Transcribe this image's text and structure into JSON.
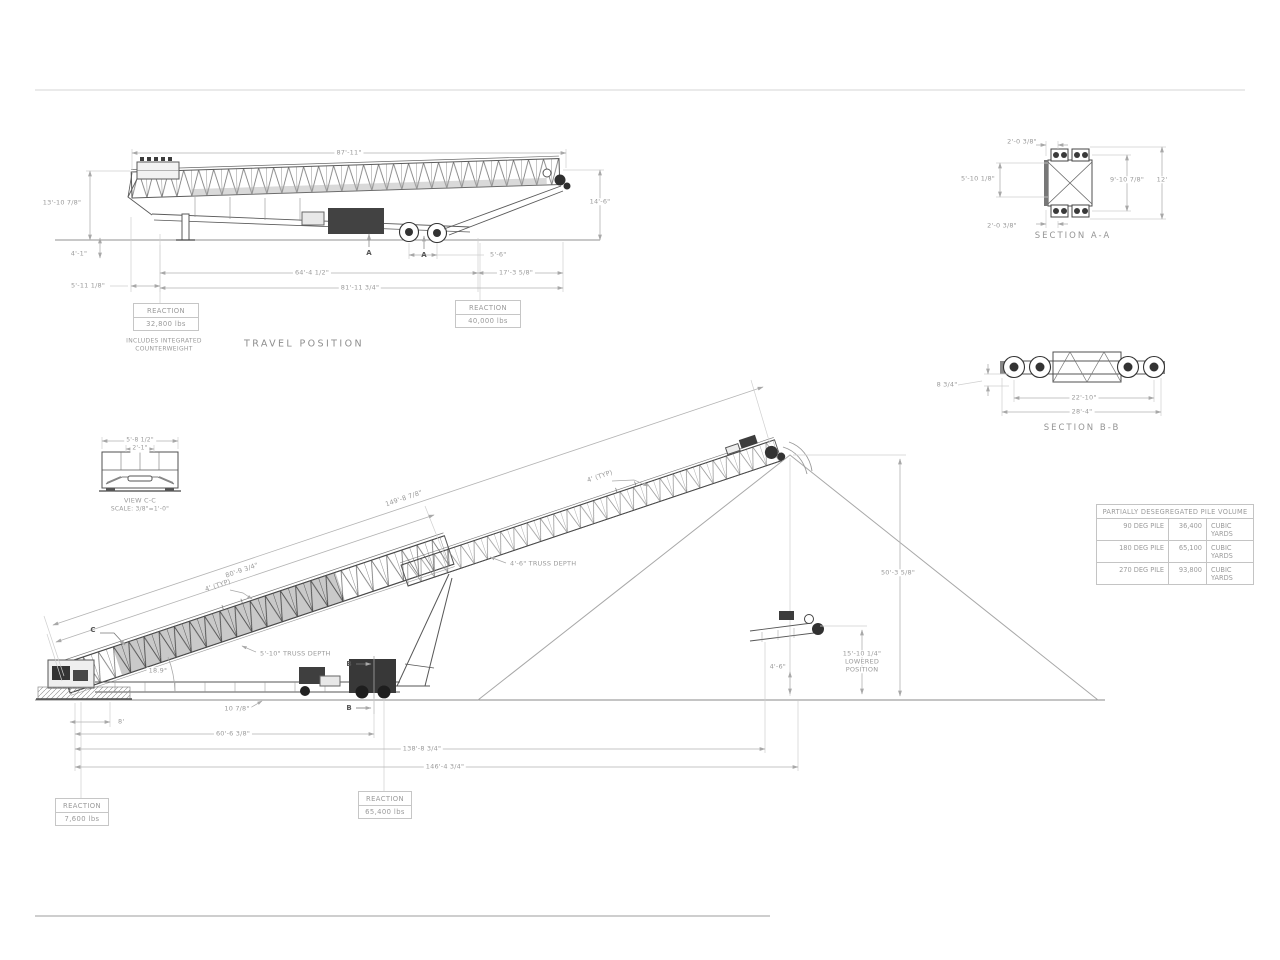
{
  "travel": {
    "title": "TRAVEL POSITION",
    "marker": "A",
    "dims": {
      "overall_top": "87'-11\"",
      "left_height": "13'-10 7/8\"",
      "right_height": "14'-6\"",
      "tail_height": "4'-1\"",
      "tail_overhang": "5'-11 1/8\"",
      "axle_span": "64'-4 1/2\"",
      "head_overhang": "17'-3 5/8\"",
      "overall_bottom": "81'-11 3/4\"",
      "axle_spacing": "5'-6\""
    },
    "reaction_left": {
      "label": "REACTION",
      "value": "32,800 lbs"
    },
    "reaction_left_note": {
      "line1": "INCLUDES INTEGRATED",
      "line2": "COUNTERWEIGHT"
    },
    "reaction_right": {
      "label": "REACTION",
      "value": "40,000 lbs"
    }
  },
  "section_aa": {
    "title": "SECTION A-A",
    "dims": {
      "top_offset": "2'-0 3/8\"",
      "left_width": "5'-10 1/8\"",
      "inner_height": "9'-10 7/8\"",
      "outer_height": "12'",
      "bottom_offset": "2'-0 3/8\""
    }
  },
  "section_bb": {
    "title": "SECTION B-B",
    "dims": {
      "drop": "8 3/4\"",
      "inner_span": "22'-10\"",
      "outer_span": "28'-4\""
    }
  },
  "view_cc": {
    "title": "VIEW C-C",
    "scale": "SCALE: 3/8\"=1'-0\"",
    "dims": {
      "outer_width": "5'-8 1/2\"",
      "inner_width": "2'-1\""
    }
  },
  "operating": {
    "marker_b": "B",
    "marker_c": "C",
    "dims": {
      "conveyor_length": "149'-8 7/8\"",
      "lower_truss_length": "80'-9 3/4\"",
      "idler_typ": "4' (TYP)",
      "upper_truss_depth": "4'-6\" TRUSS DEPTH",
      "lower_truss_depth": "5'-10\" TRUSS DEPTH",
      "incline_angle": "18.9°",
      "pile_height": "50'-3 5/8\"",
      "lowered_height": "15'-10 1/4\"",
      "lowered_word1": "LOWERED",
      "lowered_word2": "POSITION",
      "head_clearance": "4'-6\"",
      "tail_offset": "8'",
      "carriage_offset": "10 7/8\"",
      "tail_to_wheels": "60'-6 3/8\"",
      "tail_to_head_lowered": "138'-8 3/4\"",
      "tail_to_head": "146'-4 3/4\""
    },
    "reaction_tail": {
      "label": "REACTION",
      "value": "7,600 lbs"
    },
    "reaction_carriage": {
      "label": "REACTION",
      "value": "65,400 lbs"
    }
  },
  "pile_table": {
    "header": "PARTIALLY DESEGREGATED PILE VOLUME",
    "rows": [
      {
        "pile": "90 DEG PILE",
        "volume": "36,400",
        "unit": "CUBIC YARDS"
      },
      {
        "pile": "180 DEG PILE",
        "volume": "65,100",
        "unit": "CUBIC YARDS"
      },
      {
        "pile": "270 DEG PILE",
        "volume": "93,800",
        "unit": "CUBIC YARDS"
      }
    ]
  }
}
